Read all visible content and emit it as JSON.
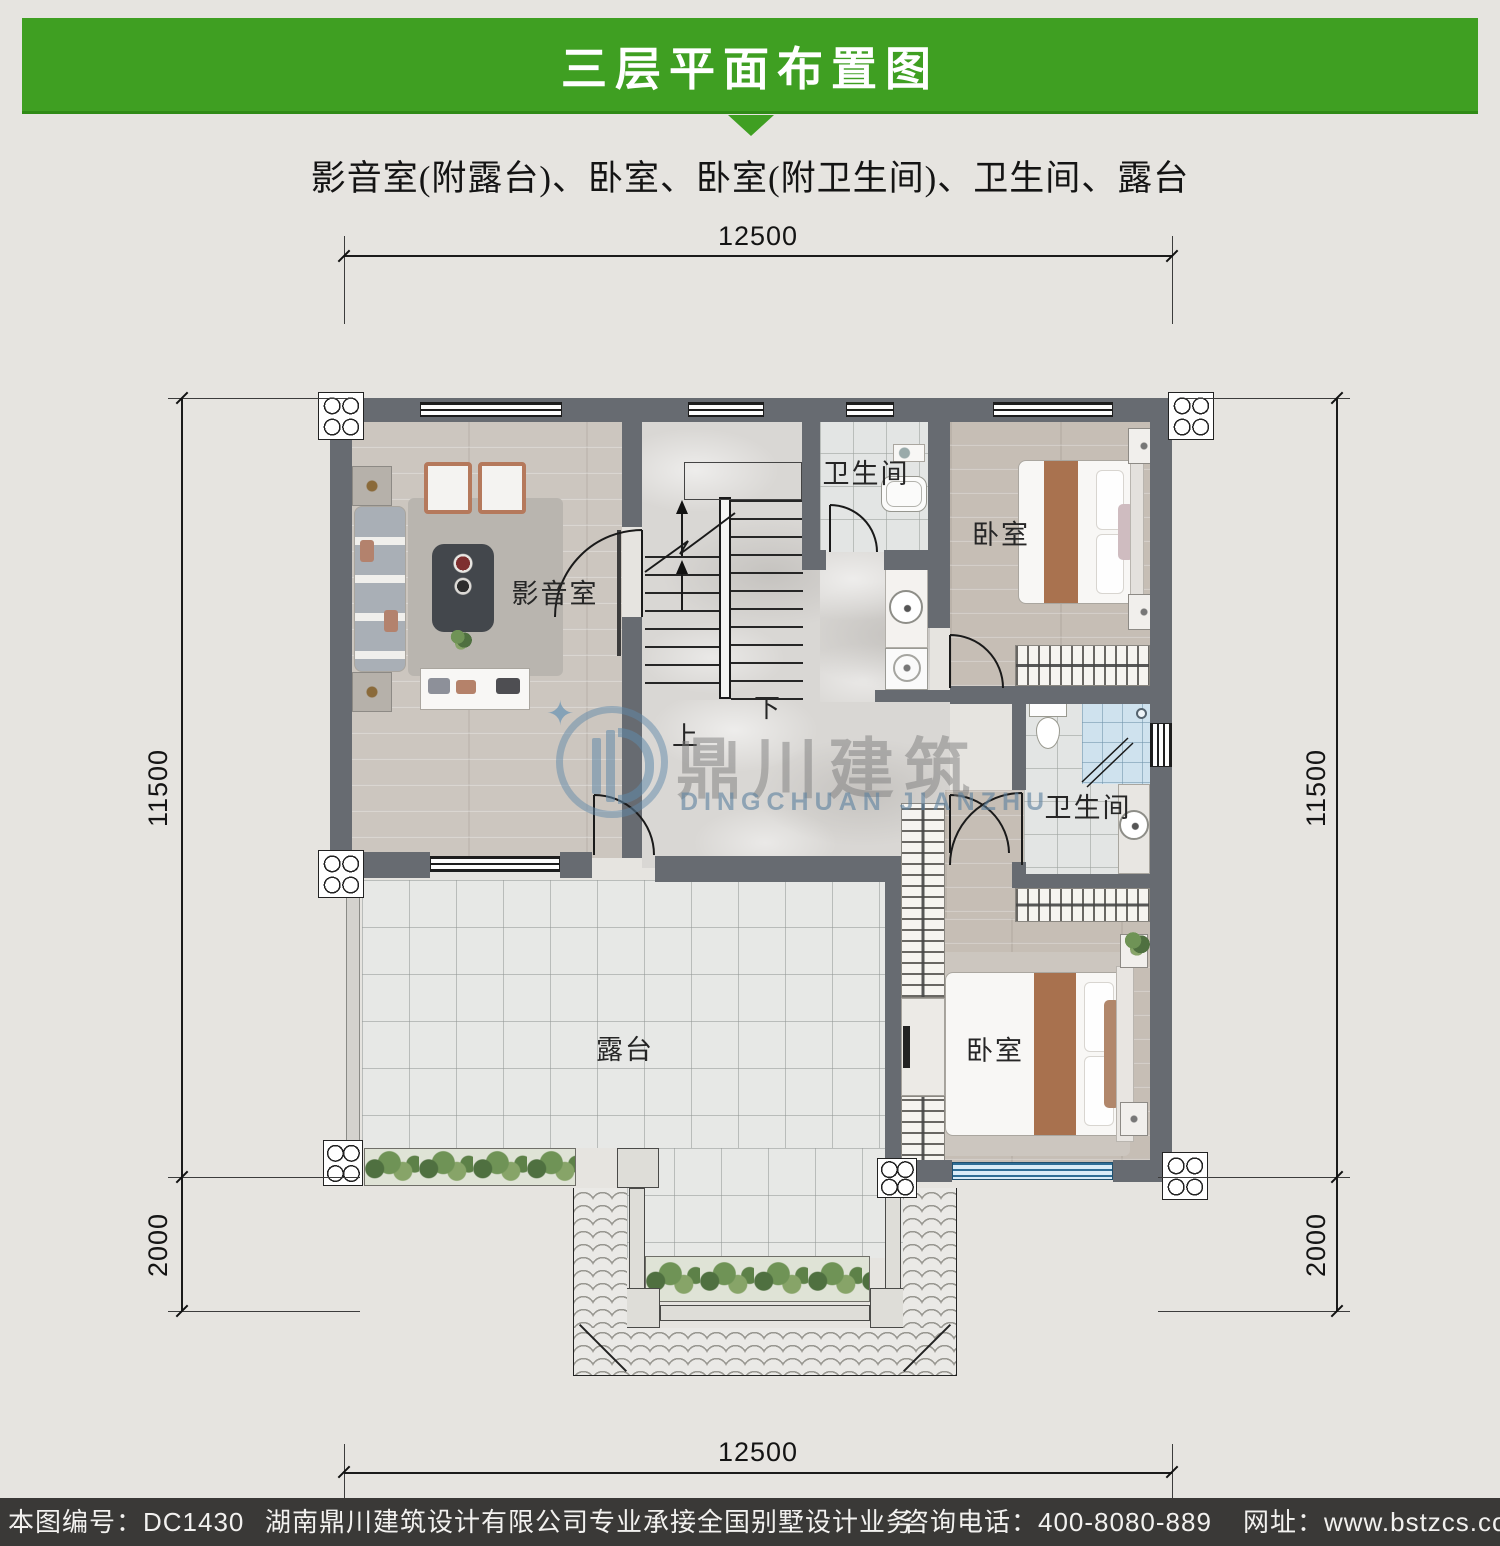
{
  "colors": {
    "accent": "#3f9f22",
    "accent-dark": "#2f8a16",
    "footer-bg": "#3a3937",
    "wall": "#676b71",
    "wm-blue": "#5d87a8"
  },
  "header": {
    "title": "三层平面布置图",
    "subtitle": "影音室(附露台)、卧室、卧室(附卫生间)、卫生间、露台"
  },
  "dims": {
    "top": "12500",
    "bottom": "12500",
    "left_main": "11500",
    "left_lower": "2000",
    "right_main": "11500",
    "right_lower": "2000"
  },
  "rooms": {
    "media": "影音室",
    "bath1": "卫生间",
    "bedroom1": "卧室",
    "bath2": "卫生间",
    "bedroom2": "卧室",
    "terrace": "露台",
    "up": "上",
    "down": "下"
  },
  "watermark": {
    "cn": "鼎川建筑",
    "en": "DINGCHUAN JIANZHU",
    "sparkle": "✦"
  },
  "footer": {
    "plan_no": "本图编号：DC1430",
    "company": "湖南鼎川建筑设计有限公司专业承接全国别墅设计业务",
    "phone": "咨询电话：400-8080-889",
    "website": "网址：www.bstzcs.com"
  }
}
